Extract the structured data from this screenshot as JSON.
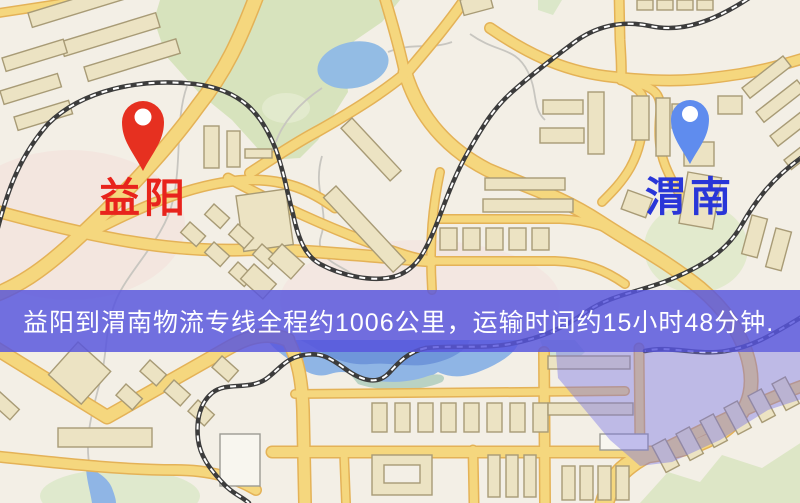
{
  "banner": {
    "text": "益阳到渭南物流专线全程约1006公里，运输时间约15小时48分钟.",
    "bg": "rgba(88,86,222,0.84)",
    "text_color": "#ffffff"
  },
  "origin": {
    "name": "益阳",
    "pin_color": "#e63020",
    "label_color": "#e8231c"
  },
  "destination": {
    "name": "渭南",
    "pin_color": "#5f8cee",
    "label_color": "#2936d8"
  },
  "route": {
    "distance_text": "约1006公里",
    "duration_text": "约15小时48分钟"
  },
  "map_colors": {
    "background": "#f3efe6",
    "road": "#f5d77e",
    "park": "#d7e3bd",
    "water": "#8fb5e5",
    "district_overlay": "rgba(116,112,230,0.42)"
  }
}
